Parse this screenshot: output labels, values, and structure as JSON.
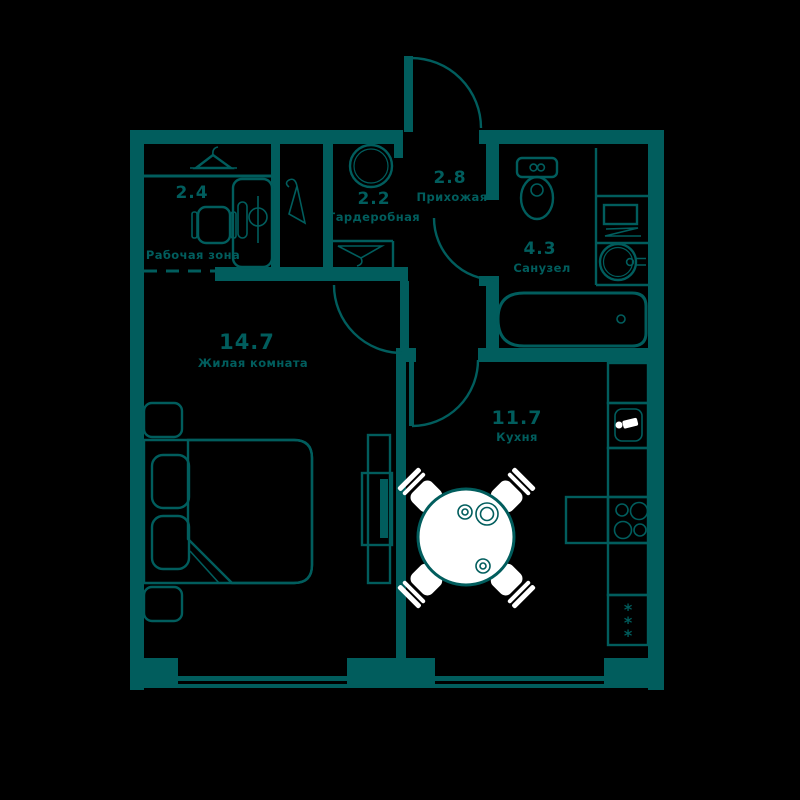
{
  "plan": {
    "title": "apartment-floor-plan",
    "rooms": [
      {
        "area": "2.4",
        "name": "Рабочая зона"
      },
      {
        "area": "2.2",
        "name": "Гардеробная"
      },
      {
        "area": "2.8",
        "name": "Прихожая"
      },
      {
        "area": "4.3",
        "name": "Санузел"
      },
      {
        "area": "14.7",
        "name": "Жилая комната"
      },
      {
        "area": "11.7",
        "name": "Кухня"
      }
    ],
    "fridge_mark": "*",
    "colors": {
      "wall": "#015d5d",
      "background": "#000000",
      "furniture_fill": "#ffffff"
    }
  }
}
